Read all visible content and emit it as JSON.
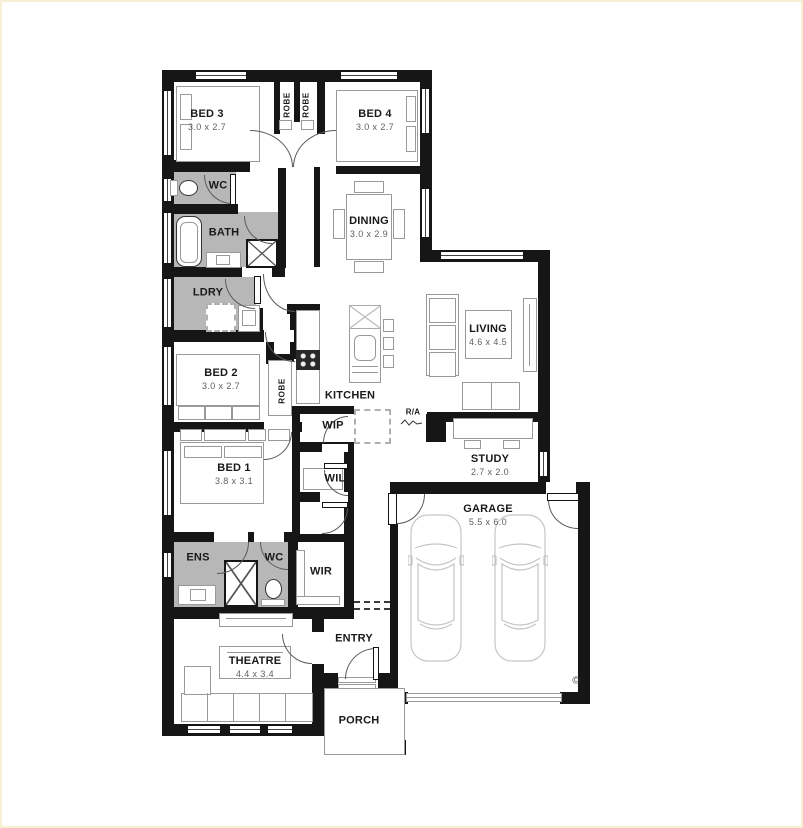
{
  "plan": {
    "rooms": {
      "bed3": {
        "name": "BED 3",
        "dims": "3.0 x 2.7"
      },
      "bed4": {
        "name": "BED 4",
        "dims": "3.0 x 2.7"
      },
      "robe_bed3": {
        "name": "ROBE"
      },
      "robe_bed4": {
        "name": "ROBE"
      },
      "wc_main": {
        "name": "WC"
      },
      "bath": {
        "name": "BATH"
      },
      "dining": {
        "name": "DINING",
        "dims": "3.0 x 2.9"
      },
      "ldry": {
        "name": "LDRY"
      },
      "bed2": {
        "name": "BED 2",
        "dims": "3.0 x 2.7"
      },
      "robe_bed2": {
        "name": "ROBE"
      },
      "kitchen": {
        "name": "KITCHEN"
      },
      "wip": {
        "name": "WIP"
      },
      "living": {
        "name": "LIVING",
        "dims": "4.6 x 4.5"
      },
      "study": {
        "name": "STUDY",
        "dims": "2.7 x 2.0"
      },
      "wil": {
        "name": "WIL"
      },
      "bed1": {
        "name": "BED 1",
        "dims": "3.8 x 3.1"
      },
      "ens": {
        "name": "ENS"
      },
      "wc_ens": {
        "name": "WC"
      },
      "wir": {
        "name": "WIR"
      },
      "garage": {
        "name": "GARAGE",
        "dims": "5.5 x 6.0"
      },
      "theatre": {
        "name": "THEATRE",
        "dims": "4.4 x 3.4"
      },
      "entry": {
        "name": "ENTRY"
      },
      "porch": {
        "name": "PORCH"
      }
    },
    "annotations": {
      "return_air": "R/A",
      "copyright": "©"
    },
    "colors": {
      "wall": "#161616",
      "wet_area": "#b7b7b7",
      "frame": "#f6efd2"
    }
  }
}
